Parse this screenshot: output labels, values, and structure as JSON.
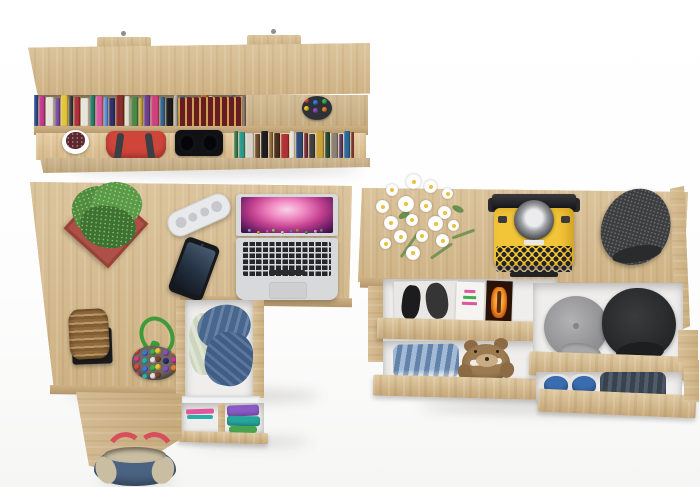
{
  "scene": {
    "background_color": "#ffffff",
    "wood_color": "#d6bc92",
    "wood_edge_color": "#b3966a",
    "floor_shadow_color": "rgba(40,35,25,0.14)"
  },
  "wall_shelf": {
    "mount_screw_color": "#8a8f94",
    "top_row_books": {
      "count": 34,
      "colors": [
        "#2e4d8e",
        "#c23a92",
        "#e8e4da",
        "#7a4fa0",
        "#e3c53c",
        "#3a3a3c",
        "#b03136",
        "#e8e4da",
        "#2a7a6e",
        "#d8589a",
        "#5b8fd4",
        "#2d2f6e",
        "#8a2d2d",
        "#e0dccf",
        "#4a8a46",
        "#caa03a",
        "#6e3f8e",
        "#d0407f",
        "#30648e",
        "#1c1c1e",
        "#b5b0a4",
        "#3f7ab0",
        "#8e2f68",
        "#2a5c46",
        "#c56a2e",
        "#e8e4da",
        "#463a7a",
        "#a83a4e",
        "#2f7f8a",
        "#d8d3c6",
        "#5a4a3a",
        "#264a7a",
        "#9e3a8a",
        "#3c3f44"
      ]
    },
    "flat_book": {
      "cover_color": "#671c21",
      "ornament_color": "#deb756"
    },
    "pen_cup": {
      "cup_color": "#2e3237",
      "pen_colors": [
        "#d84a3a",
        "#3a78d8",
        "#3fae4f",
        "#e8c43a",
        "#8a4fc0",
        "#e87f2e"
      ],
      "pen_count": 6
    },
    "plant_pot": {
      "pot_color": "#ffffff",
      "foliage_color": "#5c2730"
    },
    "handbag": {
      "body_color": "#d0453a",
      "handle_color": "#3b3e43"
    },
    "headphones": {
      "color": "#101114"
    },
    "bottom_row_books": {
      "count": 20,
      "colors": [
        "#3a7a52",
        "#2a9a8e",
        "#d8d3c8",
        "#6a4a2e",
        "#1e1e20",
        "#8a6a3a",
        "#4a2e1e",
        "#b03136",
        "#e5e1d6",
        "#2d4a7a",
        "#7a2d35",
        "#3f3f42",
        "#caa03a",
        "#274a35",
        "#8a8276",
        "#5c3a6e",
        "#2a6a9a",
        "#713028",
        "#d0cabc",
        "#35352f"
      ]
    }
  },
  "desk": {
    "plant": {
      "pot_color": "#ad5047",
      "foliage_color": "#4f8c3e",
      "foliage_dark": "#3d7330",
      "foliage_light": "#5a9b47"
    },
    "power_strip": {
      "body_color": "#e8e9eb",
      "socket_color": "#c6c9cc"
    },
    "smartphone": {
      "body_color": "#16181c",
      "screen_top": "#4a5c74",
      "screen_bottom": "#11161e"
    },
    "laptop": {
      "body_color": "#d7d9db",
      "key_color": "#26272a",
      "trackpad_color": "#cdcfd1",
      "screen_gradient": [
        "#f9d3e8",
        "#ef86c0",
        "#c2408f",
        "#6d1f66",
        "#2a0c38"
      ],
      "dock_icon_colors": [
        "#7ec4e8",
        "#f0b24a",
        "#d86a9f",
        "#9adf7c",
        "#e8e4da",
        "#5a8fd4",
        "#caa03a",
        "#4aa84e",
        "#d0d0d0",
        "#8a8f94"
      ],
      "dock_icon_count": 10
    },
    "basket": {
      "basket_color": "#a37a49",
      "tray_color": "#1a1b1d"
    },
    "bead_charm": {
      "cord_color": "#3f9b3a",
      "pouch_color": "#6f675f",
      "bead_count": 22,
      "bead_colors": [
        "#d84a3a",
        "#3a78d8",
        "#3fae4f",
        "#e8c43a",
        "#8a4fc0",
        "#e87f2e",
        "#d0407f",
        "#28b0a8",
        "#e8e4da",
        "#7a4632",
        "#2d2f6e",
        "#c23a92"
      ]
    },
    "pedestal": {
      "top_drawer": {
        "denim_color": "#48678f",
        "denim_dark": "#3f5d86",
        "shirt_color": "#ccd6bd"
      },
      "bottom_drawer": {
        "strip_colors": [
          "#d84a88",
          "#28b0a8",
          "#eeeeee"
        ],
        "stack_colors": [
          "#8a5bc4",
          "#27a69e",
          "#4aa34e"
        ]
      }
    },
    "tote_bag": {
      "denim_color": "#4a6382",
      "trim_color": "#c9bda2",
      "handle_color": "#d6505c"
    }
  },
  "chest": {
    "flowers": {
      "petal_color": "#ffffff",
      "center_color": "#e8c23a",
      "stem_color": "#7a9458",
      "leaf_color": "#6a8f4f",
      "count": 17
    },
    "typewriter": {
      "body_color": "#f2c437",
      "platen_color": "#26262a",
      "key_color": "#222327",
      "basket_silver": "#9b9da1",
      "label_color": "#e8e8e8"
    },
    "flat_cap": {
      "color": "#3b3d3f",
      "brim_color": "#2a2b2d"
    },
    "magazine_drawer": {
      "mag_fashion": {
        "bg": "#e8e7e3",
        "figure_color": "#1c1c1e"
      },
      "mag_flyer": {
        "bg": "#f5f4f1",
        "mark_colors": [
          "#e0559b",
          "#3fae4f",
          "#e0559b"
        ]
      },
      "mag_orange": {
        "bg": "#2a1206",
        "flame_colors": [
          "#ffd27a",
          "#f08c1e",
          "#a33708"
        ]
      }
    },
    "jeans_teddy_drawer": {
      "jeans_color": "#7fa0c6",
      "teddy_color": "#9c7b52",
      "teddy_muzzle": "#c9ad85",
      "teddy_band": "#f0ede6"
    },
    "caps_drawer": {
      "gray_cap_color": "#9b9b9d",
      "black_cap_color": "#2b2c2e"
    },
    "shoes_drawer": {
      "shoe_color": "#3a6cb0",
      "sole_color": "#e4e4e2",
      "jeans_color": "#39434f"
    }
  }
}
